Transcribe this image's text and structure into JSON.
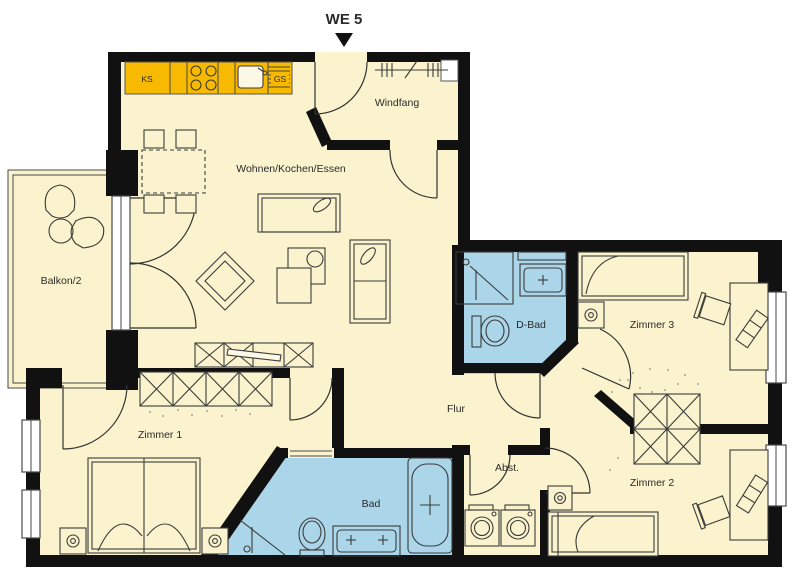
{
  "title": "WE 5",
  "rooms": {
    "living": {
      "label": "Wohnen/Kochen/Essen"
    },
    "windfang": {
      "label": "Windfang"
    },
    "balcony": {
      "label": "Balkon/2"
    },
    "shower_bath": {
      "label": "D-Bad"
    },
    "room3": {
      "label": "Zimmer 3"
    },
    "room1": {
      "label": "Zimmer 1"
    },
    "hall": {
      "label": "Flur"
    },
    "storage": {
      "label": "Abst."
    },
    "bath": {
      "label": "Bad"
    },
    "room2": {
      "label": "Zimmer 2"
    }
  },
  "kitchen": {
    "fridge_label": "KS",
    "dishwasher_label": "GS"
  },
  "colors": {
    "wall": "#111111",
    "room_fill": "#faf3cd",
    "wet_room_fill": "#abd5e8",
    "kitchen_unit": "#f7ba00",
    "background": "#ffffff",
    "furniture_line": "#3b3b3b",
    "label_text": "#2b2b2b"
  }
}
